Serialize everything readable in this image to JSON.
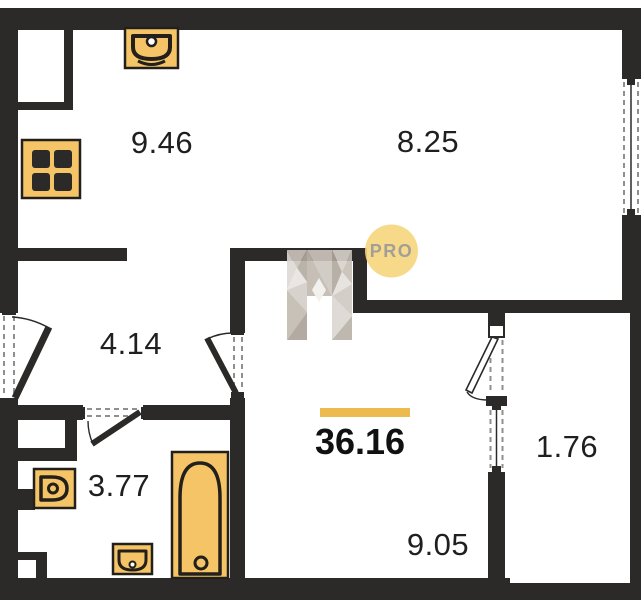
{
  "watermark": {
    "label": "PRO"
  },
  "total_area": "36.16",
  "rooms": {
    "kitchen": "9.46",
    "room": "8.25",
    "hallway": "4.14",
    "bathroom": "3.77",
    "living": "9.05",
    "balcony": "1.76"
  },
  "fixtures": [
    "kitchen-sink",
    "stove",
    "toilet",
    "washbasin",
    "bathtub"
  ],
  "colors": {
    "wall": "#2B2A29",
    "fixture_fill": "#F5C466",
    "fixture_stroke": "#23201C",
    "accent_bar": "#EDBA4F",
    "watermark_circle": "#F6D77D",
    "watermark_text": "#9B948D",
    "dash": "#8F8F8F",
    "label_text": "#1F1F1F"
  }
}
